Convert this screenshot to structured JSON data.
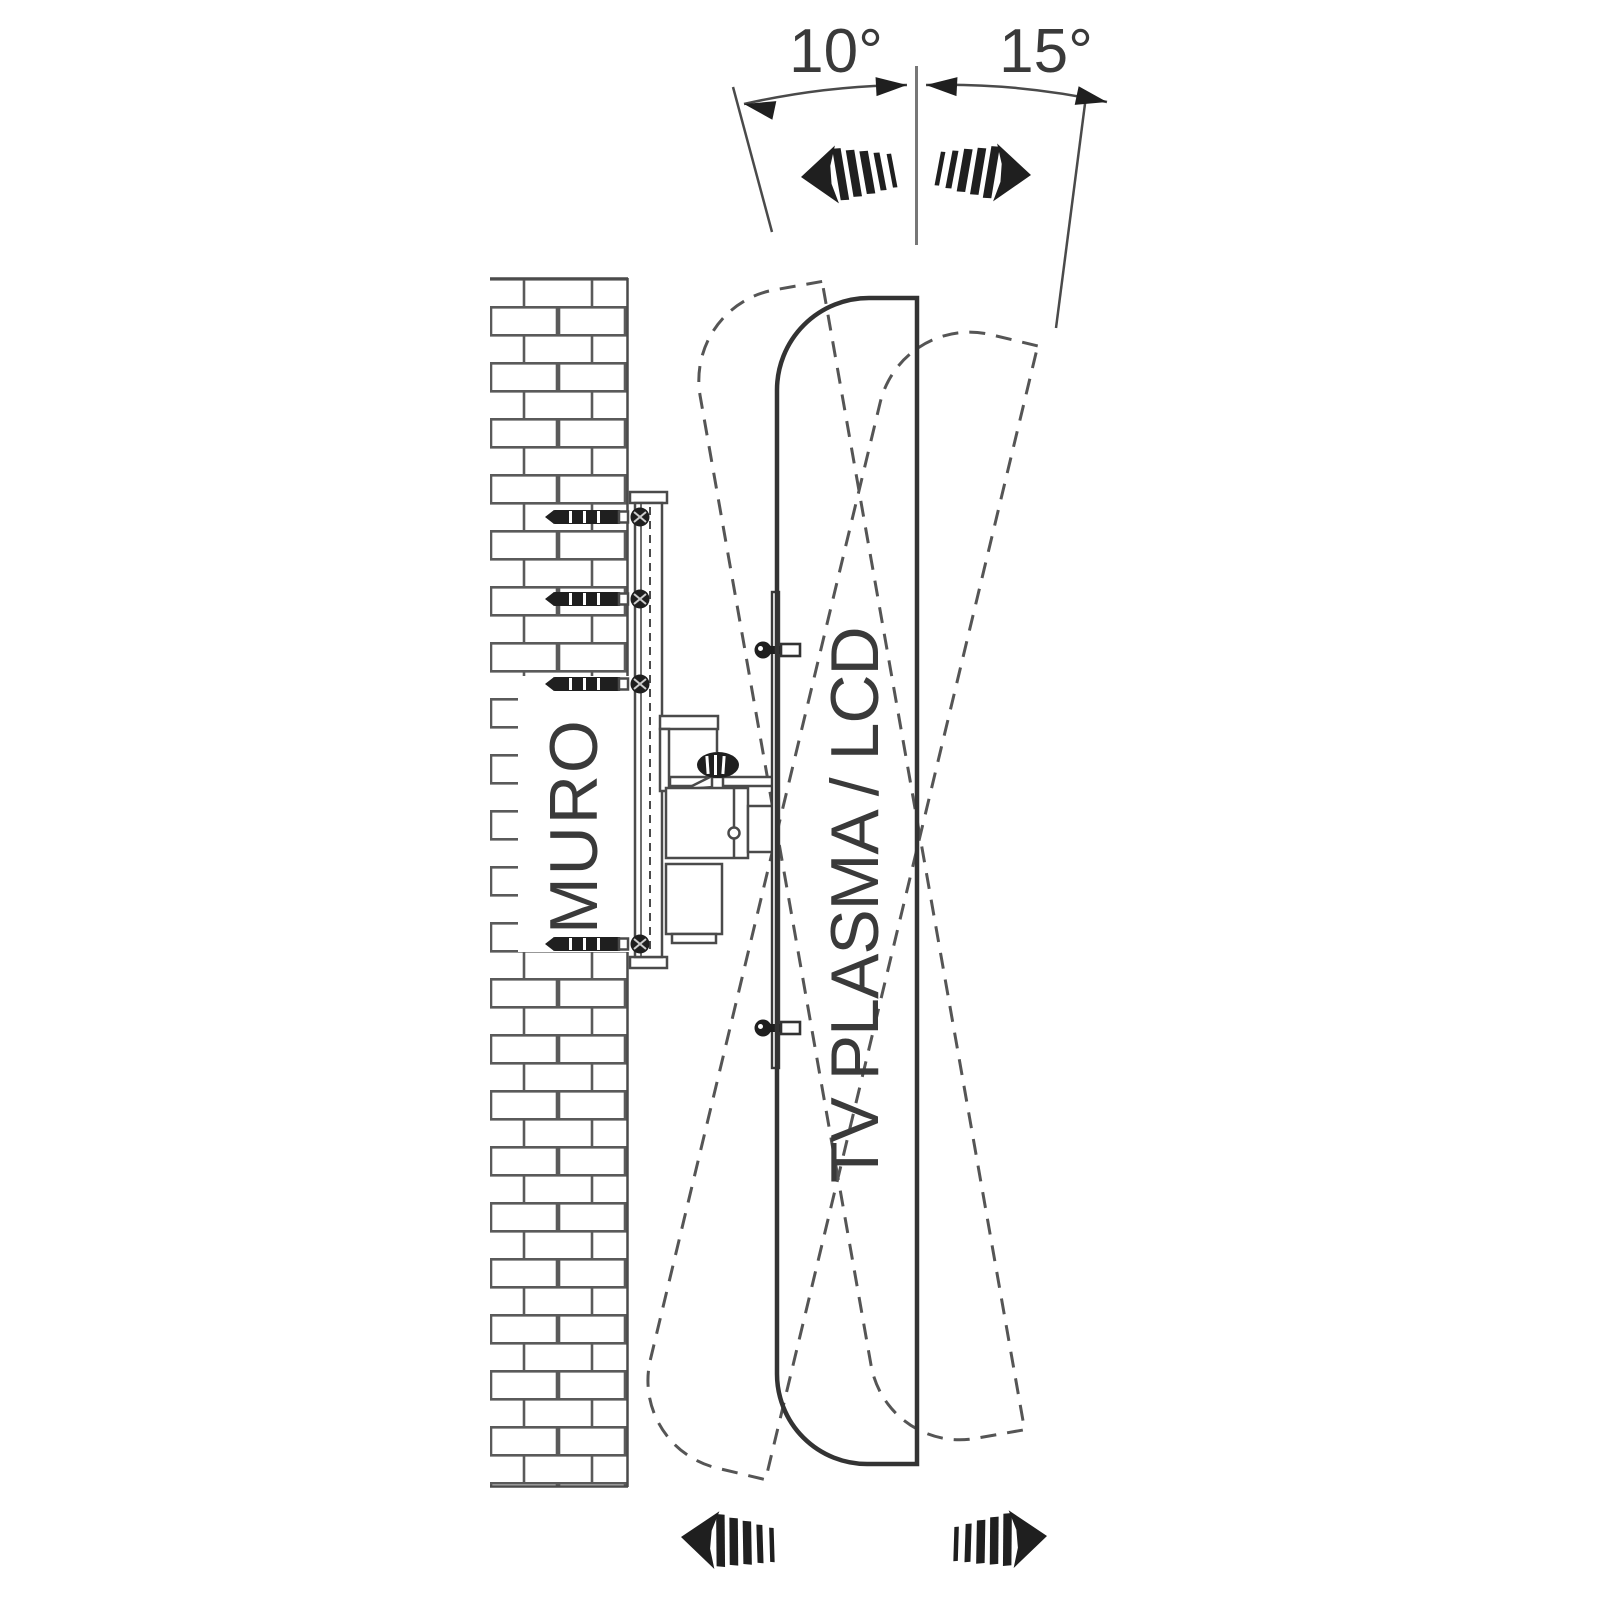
{
  "scene": {
    "labels": {
      "wall": "MURO",
      "tv": "TV PLASMA / LCD",
      "tilt_toward_wall": "10°",
      "tilt_away_from_wall": "15°"
    },
    "angles": {
      "toward_wall_deg": 10,
      "away_from_wall_deg": 15
    },
    "colors": {
      "background": "#ffffff",
      "line": "#4a4a4a",
      "dark_fill": "#1f1f1f",
      "tv_outline": "#333333",
      "dashed_outline": "#555555",
      "text": "#3a3a3a"
    }
  }
}
